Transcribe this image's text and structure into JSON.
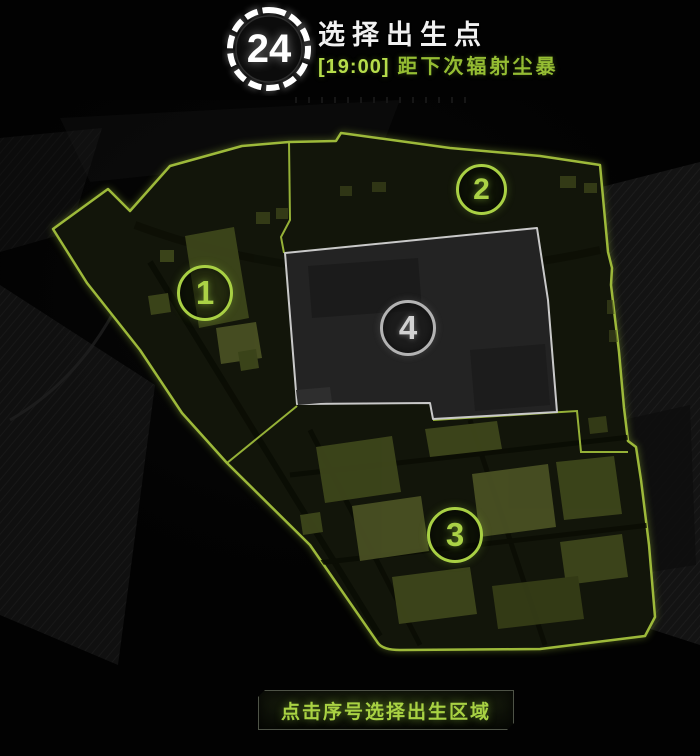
{
  "header": {
    "timer_seconds": "24",
    "title": "选择出生点",
    "storm_countdown_time": "[19:00]",
    "storm_countdown_label": "距下次辐射尘暴"
  },
  "zones": [
    {
      "label": "1",
      "state": "available"
    },
    {
      "label": "2",
      "state": "available"
    },
    {
      "label": "3",
      "state": "available"
    },
    {
      "label": "4",
      "state": "locked"
    }
  ],
  "footer": {
    "hint": "点击序号选择出生区域"
  },
  "colors": {
    "accent_green": "#a9d044",
    "map_outline_green": "#9db93a",
    "storm_text_green": "#95bd33",
    "locked_zone_gray": "#b3b3b3"
  }
}
